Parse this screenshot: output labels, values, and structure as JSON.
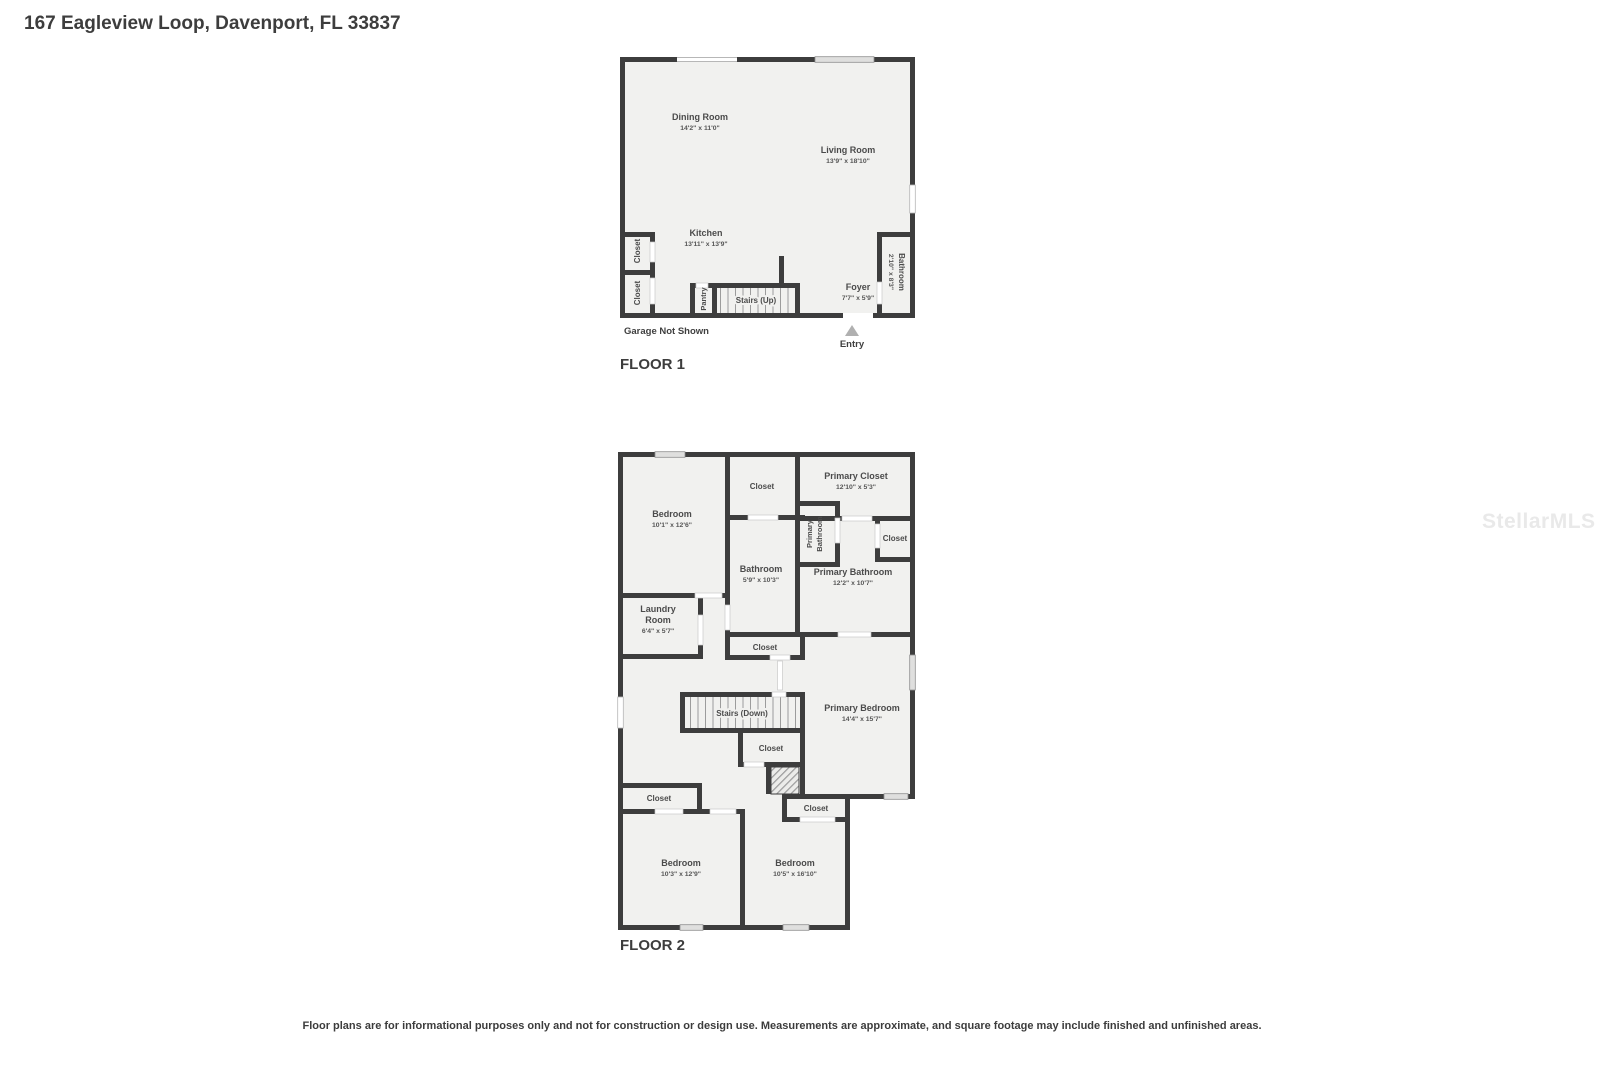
{
  "page": {
    "title": "167 Eagleview Loop, Davenport, FL 33837",
    "watermark": "StellarMLS",
    "disclaimer": "Floor plans are for informational purposes only and not for construction or design use. Measurements are approximate, and square footage may include finished and unfinished areas."
  },
  "floor1": {
    "label": "FLOOR 1",
    "garage_note": "Garage Not Shown",
    "entry_label": "Entry",
    "rooms": {
      "dining_room": {
        "name": "Dining Room",
        "dims": "14'2\" x 11'0\""
      },
      "living_room": {
        "name": "Living Room",
        "dims": "13'9\" x 18'10\""
      },
      "kitchen": {
        "name": "Kitchen",
        "dims": "13'11\" x 13'9\""
      },
      "foyer": {
        "name": "Foyer",
        "dims": "7'7\" x 5'9\""
      },
      "bathroom": {
        "name": "Bathroom",
        "dims": "2'10\" x 8'3\""
      },
      "closet_upper": {
        "name": "Closet"
      },
      "closet_lower": {
        "name": "Closet"
      },
      "pantry": {
        "name": "Pantry"
      },
      "stairs": {
        "name": "Stairs (Up)"
      }
    }
  },
  "floor2": {
    "label": "FLOOR 2",
    "rooms": {
      "bedroom_top": {
        "name": "Bedroom",
        "dims": "10'1\" x 12'6\""
      },
      "closet_top": {
        "name": "Closet"
      },
      "primary_closet": {
        "name": "Primary Closet",
        "dims": "12'10\" x 5'3\""
      },
      "primary_bathroom_wc": {
        "name_line1": "Primary",
        "name_line2": "Bathroom"
      },
      "closet_right": {
        "name": "Closet"
      },
      "bathroom": {
        "name": "Bathroom",
        "dims": "5'9\" x 10'3\""
      },
      "primary_bathroom": {
        "name": "Primary Bathroom",
        "dims": "12'2\" x 10'7\""
      },
      "laundry": {
        "name_line1": "Laundry",
        "name_line2": "Room",
        "dims": "6'4\" x 5'7\""
      },
      "closet_hall": {
        "name": "Closet"
      },
      "stairs": {
        "name": "Stairs (Down)"
      },
      "primary_bedroom": {
        "name": "Primary Bedroom",
        "dims": "14'4\" x 15'7\""
      },
      "closet_stairs": {
        "name": "Closet"
      },
      "closet_left": {
        "name": "Closet"
      },
      "closet_bottom": {
        "name": "Closet"
      },
      "bedroom_left": {
        "name": "Bedroom",
        "dims": "10'3\" x 12'9\""
      },
      "bedroom_mid": {
        "name": "Bedroom",
        "dims": "10'5\" x 16'10\""
      }
    }
  },
  "colors": {
    "wall": "#3d3d3d",
    "room_fill": "#f1f1ef",
    "text": "#4b4b4b",
    "window_fill": "#dfdfde",
    "entry_marker": "#b0b0b0"
  }
}
